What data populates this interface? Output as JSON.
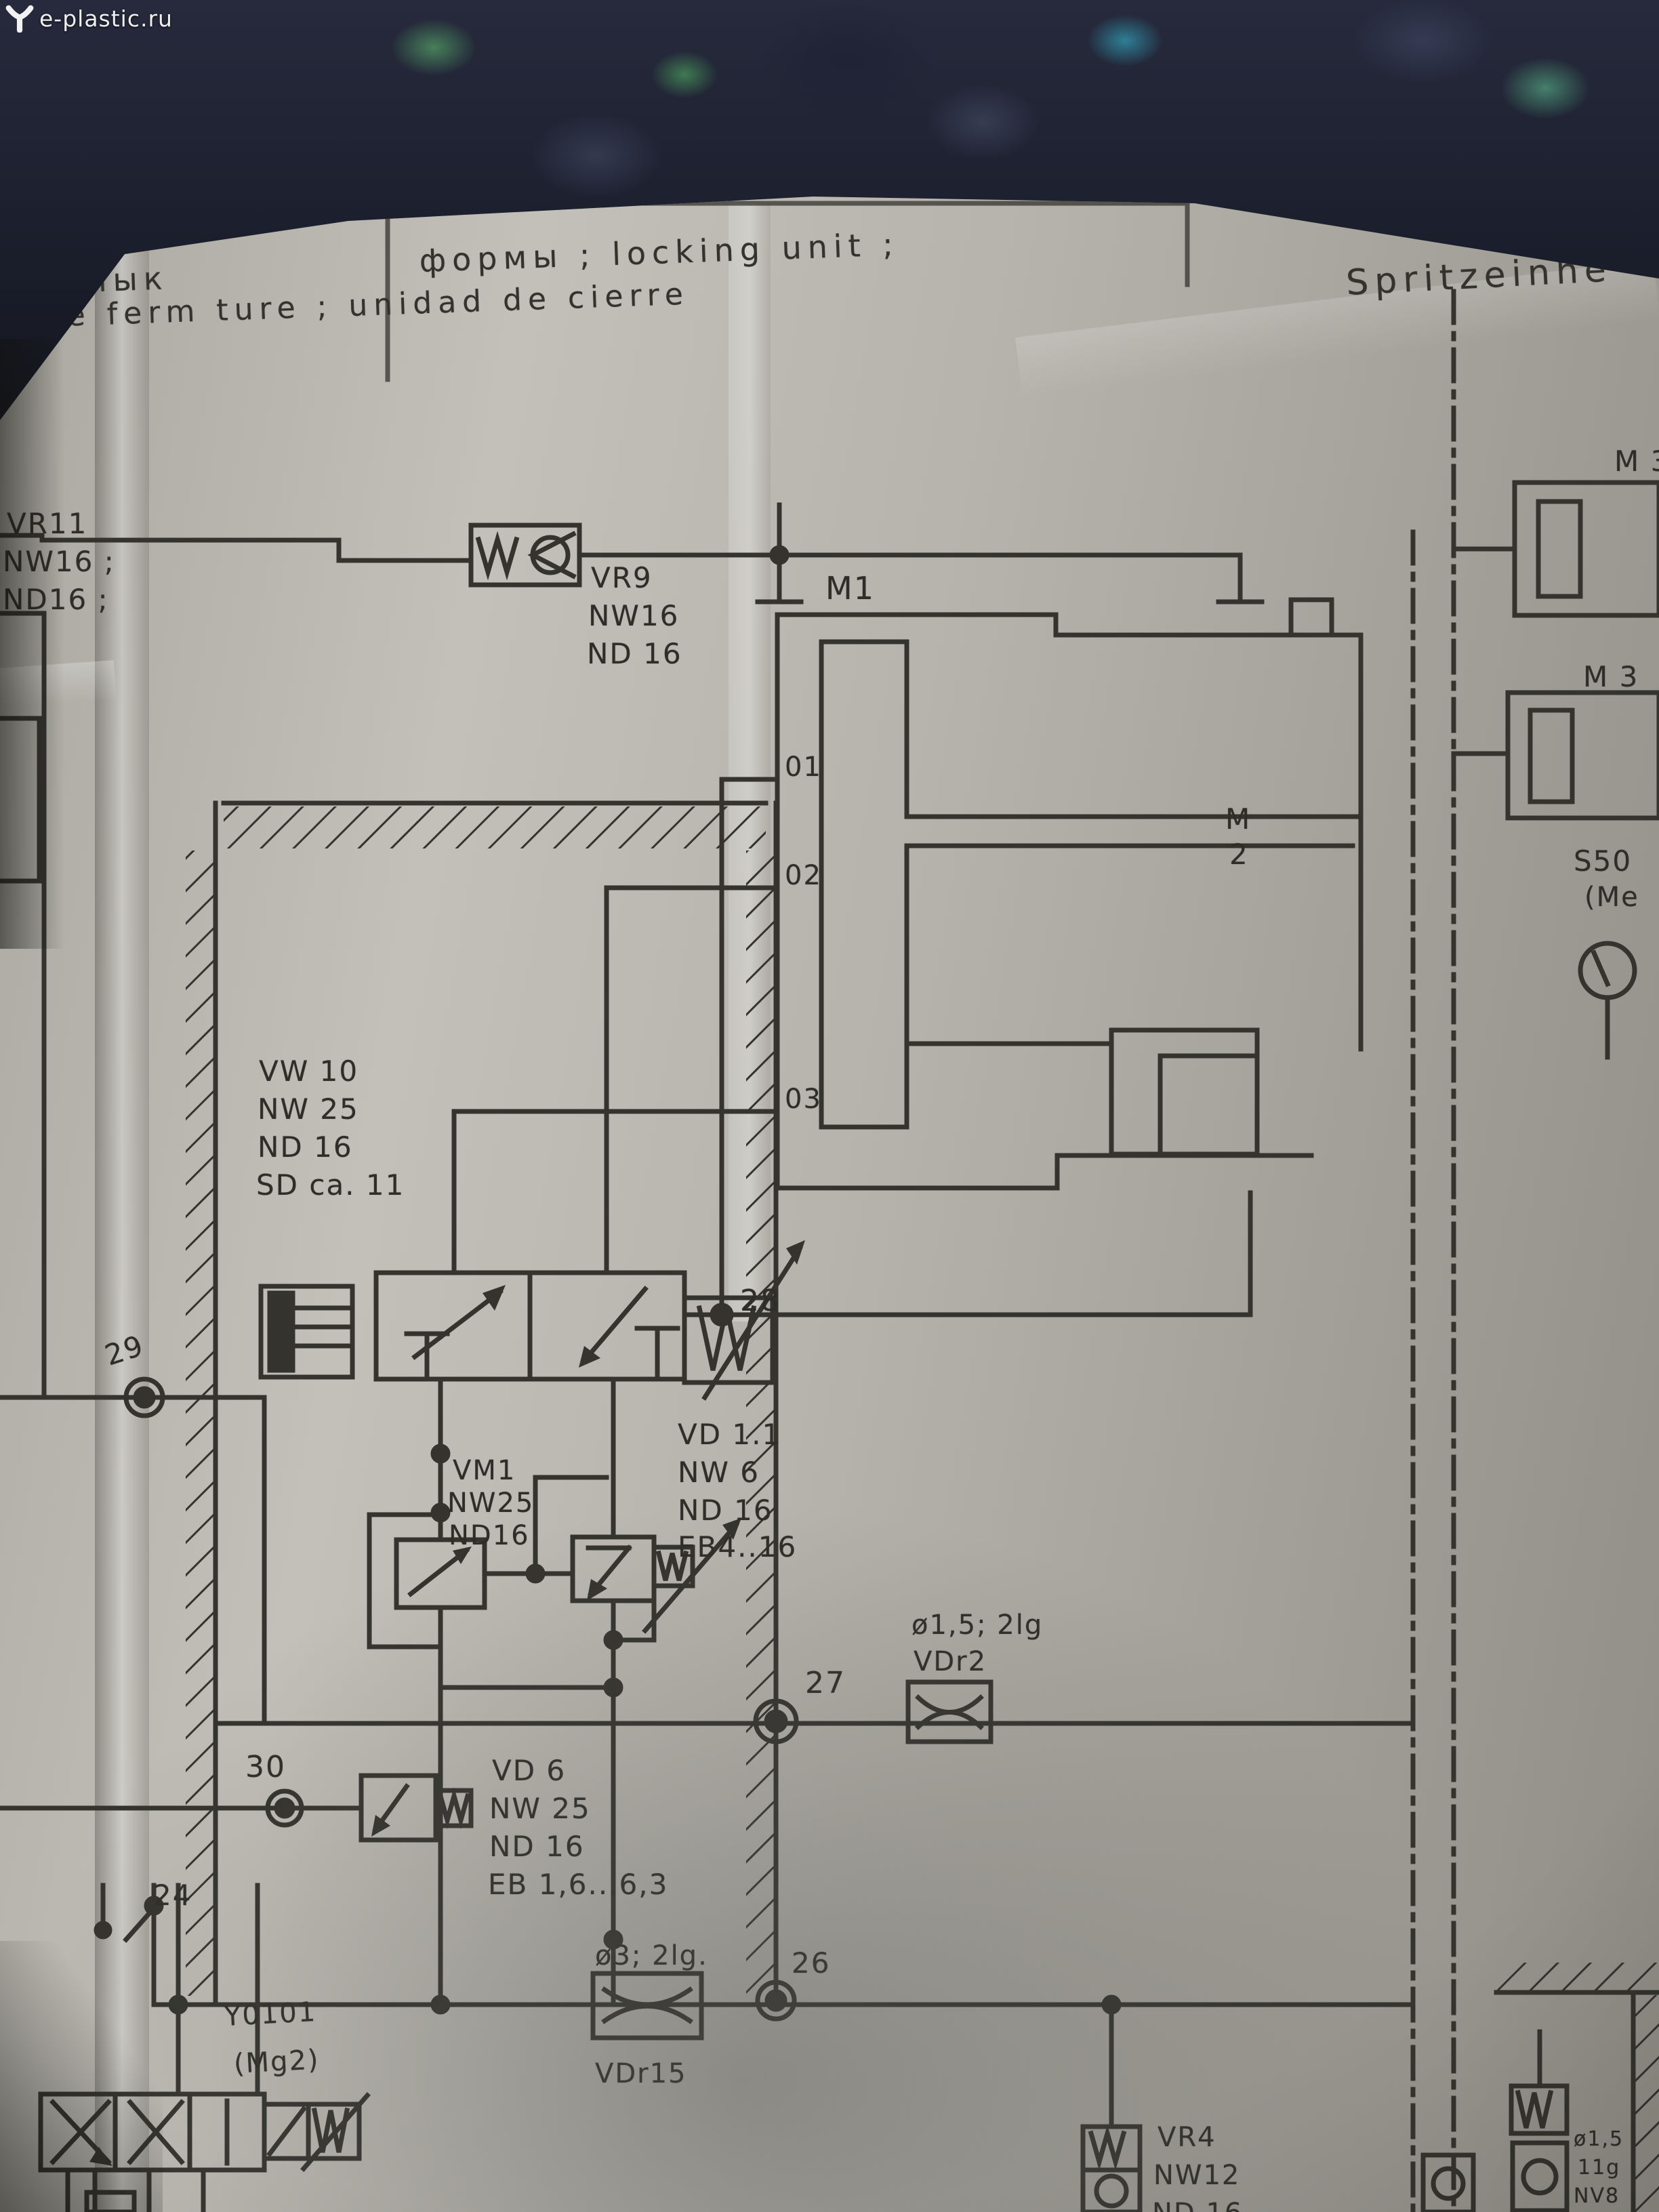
{
  "watermark": {
    "text": "e-plastic.ru"
  },
  "header": {
    "title_ru_fragment": "п  смык",
    "title_line1": "формы ; locking unit ;",
    "title_line2": "e de  ferm ture  ; unidad de cierre",
    "section_right": "Spritzeinhe"
  },
  "labels": {
    "vr11_1": "VR11",
    "vr11_2": "NW16 ;",
    "vr11_3": "ND16 ;",
    "vr9_1": "VR9",
    "vr9_2": "NW16",
    "vr9_3": "ND 16",
    "m1": "M1",
    "m2_1": "M",
    "m2_2": "2",
    "port1": "01",
    "port2": "02",
    "port3": "03",
    "vw10_1": "VW 10",
    "vw10_2": "NW 25",
    "vw10_3": "ND 16",
    "vw10_4": "SD ca. 11",
    "n29": "29",
    "n28": "28",
    "n27": "27",
    "n30": "30",
    "n26": "26",
    "n24": "24",
    "vm1_1": "VM1",
    "vm1_2": "NW25",
    "vm1_3": "ND16",
    "vd11_1": "VD 1.1",
    "vd11_2": "NW  6",
    "vd11_3": "ND 16",
    "vd11_4": "EB4..16",
    "vdr2_1": "ø1,5; 2lg",
    "vdr2_2": "VDr2",
    "vd6_1": "VD  6",
    "vd6_2": "NW 25",
    "vd6_3": "ND 16",
    "vd6_4": "EB 1,6...6,3",
    "y0101_1": "Y0101",
    "y0101_2": "(Mg2)",
    "vdr15_1": "ø3; 2lg.",
    "vdr15_2": "VDr15",
    "vr4_1": "VR4",
    "vr4_2": "NW12",
    "vr4_3": "ND 16",
    "m3_top": "M 3",
    "m3_mid": "M 3",
    "s50_1": "S50",
    "s50_2": "(Me",
    "br_1": "ø1,5",
    "br_2": "11g",
    "br_3": "NV8"
  }
}
